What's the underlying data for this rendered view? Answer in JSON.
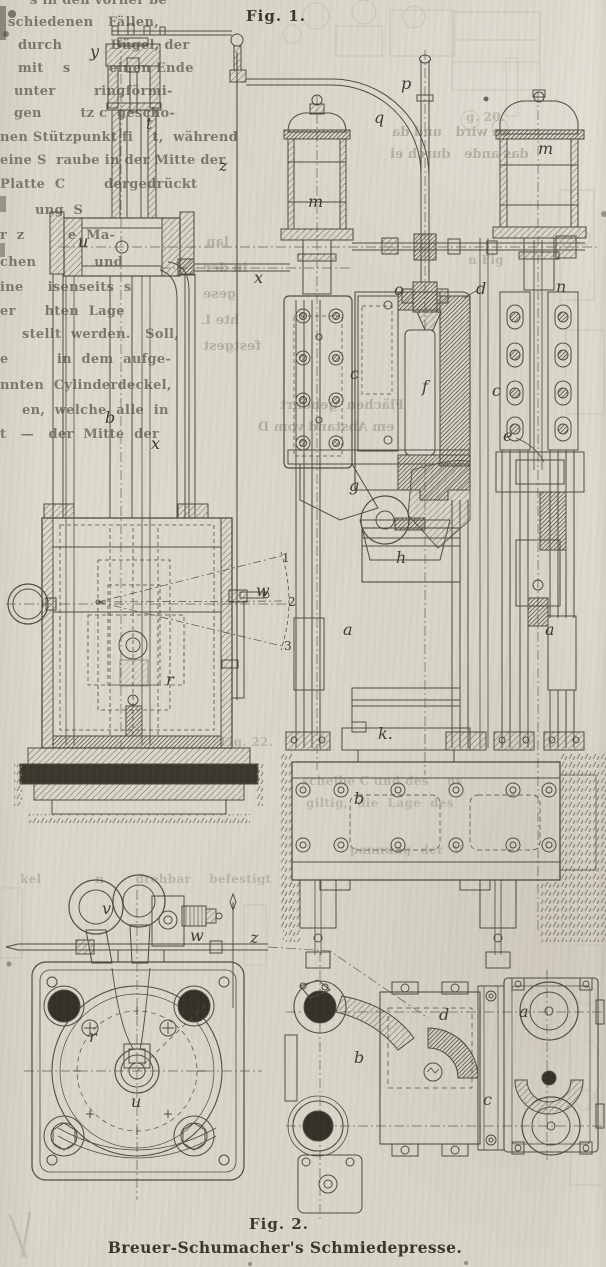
{
  "page": {
    "fig1_label": "Fig. 1.",
    "fig2_label": "Fig. 2.",
    "caption": "Breuer-Schumacher's Schmiedepresse.",
    "paper_color": "#d8d4c8",
    "ink_color": "#4e4a40"
  },
  "fig1": {
    "part_labels": [
      {
        "t": "y",
        "x": 90,
        "y": 44
      },
      {
        "t": "t",
        "x": 146,
        "y": 116
      },
      {
        "t": "z",
        "x": 219,
        "y": 158
      },
      {
        "t": "u",
        "x": 78,
        "y": 234
      },
      {
        "t": "x",
        "x": 254,
        "y": 270
      },
      {
        "t": "b",
        "x": 105,
        "y": 410
      },
      {
        "t": "x",
        "x": 151,
        "y": 436
      },
      {
        "t": "w",
        "x": 256,
        "y": 583
      },
      {
        "t": "r",
        "x": 166,
        "y": 672
      },
      {
        "t": "1",
        "x": 282,
        "y": 552
      },
      {
        "t": "2",
        "x": 288,
        "y": 596
      },
      {
        "t": "3",
        "x": 284,
        "y": 640
      },
      {
        "t": "p",
        "x": 401,
        "y": 76
      },
      {
        "t": "q",
        "x": 374,
        "y": 110
      },
      {
        "t": "m",
        "x": 308,
        "y": 194
      },
      {
        "t": "m",
        "x": 538,
        "y": 141
      },
      {
        "t": "o",
        "x": 394,
        "y": 282
      },
      {
        "t": "d",
        "x": 476,
        "y": 281
      },
      {
        "t": "n",
        "x": 556,
        "y": 279
      },
      {
        "t": "c",
        "x": 350,
        "y": 366
      },
      {
        "t": "f",
        "x": 422,
        "y": 379
      },
      {
        "t": "c",
        "x": 492,
        "y": 383
      },
      {
        "t": "e",
        "x": 503,
        "y": 428
      },
      {
        "t": "g",
        "x": 349,
        "y": 478
      },
      {
        "t": "h",
        "x": 396,
        "y": 550
      },
      {
        "t": "a",
        "x": 343,
        "y": 622
      },
      {
        "t": "a",
        "x": 545,
        "y": 622
      },
      {
        "t": "k.",
        "x": 378,
        "y": 726
      },
      {
        "t": "b",
        "x": 354,
        "y": 791
      }
    ]
  },
  "fig2": {
    "part_labels": [
      {
        "t": "v",
        "x": 102,
        "y": 901
      },
      {
        "t": "w",
        "x": 190,
        "y": 928
      },
      {
        "t": "z",
        "x": 250,
        "y": 930
      },
      {
        "t": "r",
        "x": 89,
        "y": 1029
      },
      {
        "t": "u",
        "x": 131,
        "y": 1094
      },
      {
        "t": "d",
        "x": 439,
        "y": 1007
      },
      {
        "t": "a",
        "x": 519,
        "y": 1004
      },
      {
        "t": "b",
        "x": 354,
        "y": 1050
      },
      {
        "t": "c",
        "x": 483,
        "y": 1092
      }
    ]
  },
  "body_text": {
    "fragments": [
      {
        "x": 30,
        "y": -6,
        "t": "s in den vorher be"
      },
      {
        "x": 8,
        "y": 16,
        "t": "schiedenen   Fällen,"
      },
      {
        "x": 18,
        "y": 39,
        "t": "durch          Bügel, der"
      },
      {
        "x": 18,
        "y": 62,
        "t": "mit    s        einen Ende"
      },
      {
        "x": 14,
        "y": 85,
        "t": "unter        ringförmi-"
      },
      {
        "x": 14,
        "y": 107,
        "t": "gen        tz c  gescho-"
      },
      {
        "x": 0,
        "y": 131,
        "t": "nen Stützpunkt fi    t,  während"
      },
      {
        "x": 0,
        "y": 154,
        "t": "eine S  raube in der Mitte der"
      },
      {
        "x": 0,
        "y": 178,
        "t": "Platte  C        dergedrückt"
      },
      {
        "x": 6,
        "y": 204,
        "t": "      ung  S"
      },
      {
        "x": 0,
        "y": 229,
        "t": "r  z         e  Ma-"
      },
      {
        "x": 0,
        "y": 256,
        "t": "chen            und"
      },
      {
        "x": 0,
        "y": 281,
        "t": "ine     isenseits  s"
      },
      {
        "x": 0,
        "y": 305,
        "t": "er      hten  Lage"
      },
      {
        "x": 22,
        "y": 328,
        "t": "stellt  werden.   Soll,"
      },
      {
        "x": 0,
        "y": 353,
        "t": "e          in  dem  aufge-"
      },
      {
        "x": 0,
        "y": 379,
        "t": "nnten  Cylinderdeckel,"
      },
      {
        "x": 22,
        "y": 404,
        "t": "en,  welche  alle  in"
      },
      {
        "x": 0,
        "y": 428,
        "t": "t   —   der  Mitte  der"
      }
    ]
  },
  "ghost_text": {
    "mirrored": [
      {
        "x": 392,
        "y": 126,
        "t": "en wird   und da"
      },
      {
        "x": 390,
        "y": 148,
        "t": "das ande   durch ei"
      },
      {
        "x": 206,
        "y": 236,
        "t": "lan"
      },
      {
        "x": 204,
        "y": 262,
        "t": "in der"
      },
      {
        "x": 203,
        "y": 288,
        "t": "gese"
      },
      {
        "x": 202,
        "y": 314,
        "t": "hte L"
      },
      {
        "x": 203,
        "y": 340,
        "t": "festgest"
      },
      {
        "x": 280,
        "y": 399,
        "t": "Flächen  gebohrt"
      },
      {
        "x": 258,
        "y": 421,
        "t": "em Abstand vom D"
      }
    ],
    "faint": [
      {
        "x": 466,
        "y": 111,
        "t": "g. 20."
      },
      {
        "x": 468,
        "y": 254,
        "t": "n Fig"
      },
      {
        "x": 220,
        "y": 736,
        "t": "Fig. 22."
      },
      {
        "x": 302,
        "y": 775,
        "t": "scheibe C und des    ns"
      },
      {
        "x": 306,
        "y": 797,
        "t": "giltig,  die  Lage  des"
      },
      {
        "x": 350,
        "y": 844,
        "t": "pannung  der  V"
      },
      {
        "x": 20,
        "y": 873,
        "t": "kel            n       drehbar    befestigt"
      }
    ]
  }
}
